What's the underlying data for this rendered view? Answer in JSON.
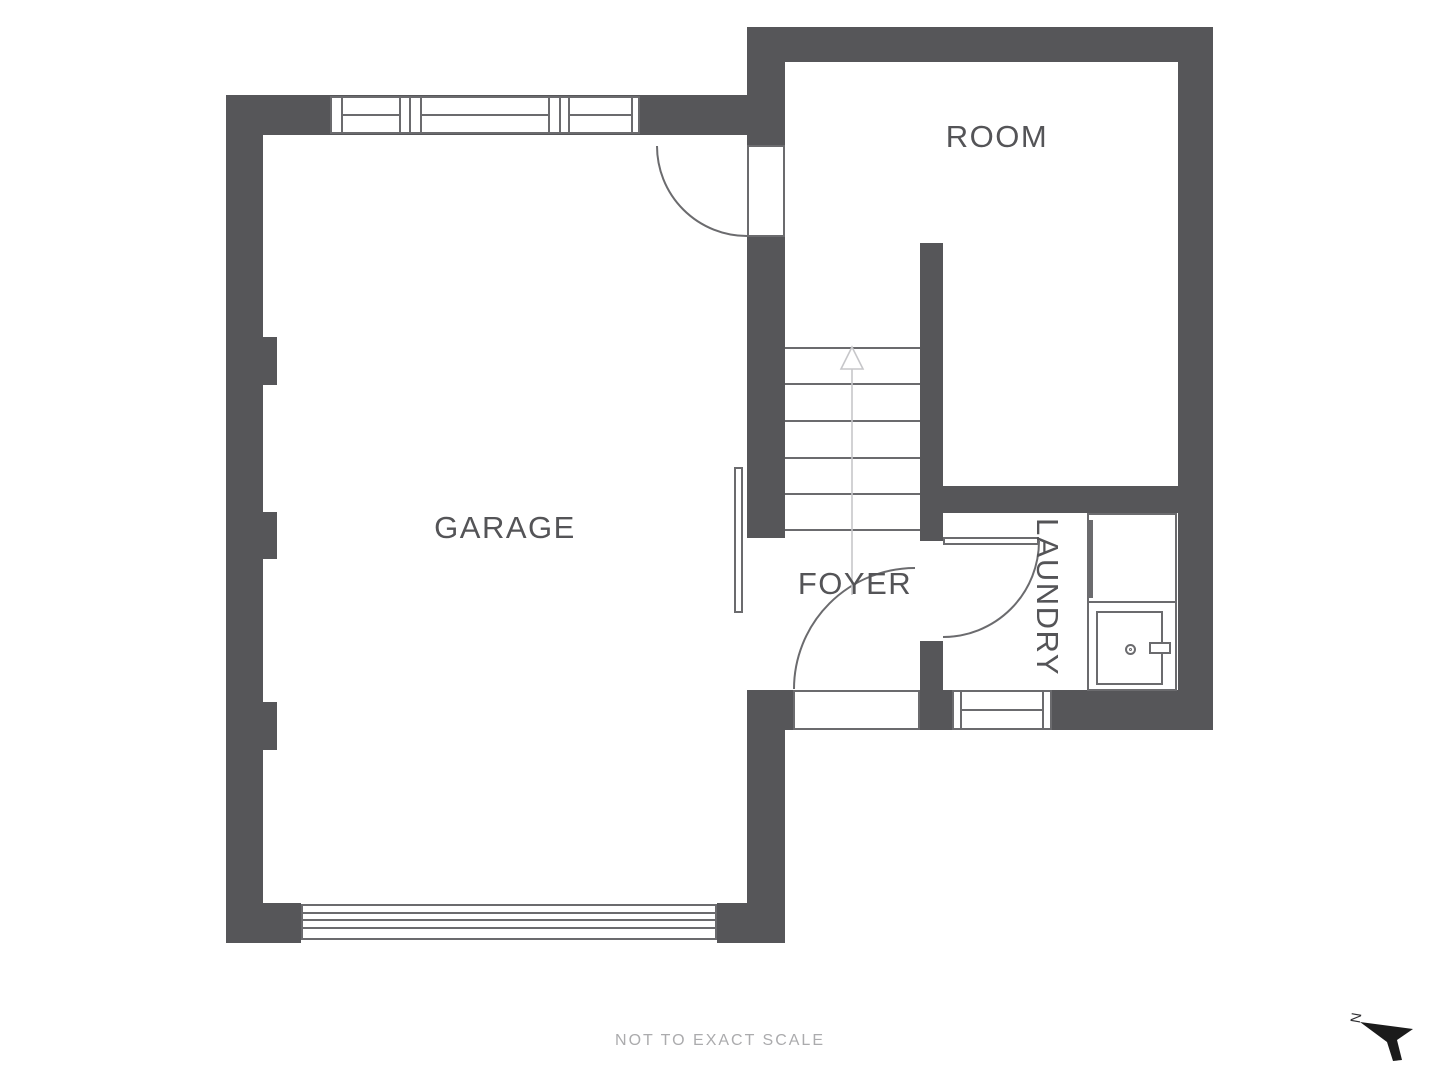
{
  "colors": {
    "wall": "#565659",
    "line": "#6b6b6e",
    "label": "#545457",
    "muted": "#ababad",
    "arrow": "#c7c7ca",
    "north": "#1b1b1b"
  },
  "rooms": {
    "garage": "GARAGE",
    "room": "ROOM",
    "foyer": "FOYER",
    "laundry": "LAUNDRY"
  },
  "footer": {
    "scale_note": "NOT TO EXACT SCALE"
  },
  "compass": {
    "north_label": "N"
  }
}
